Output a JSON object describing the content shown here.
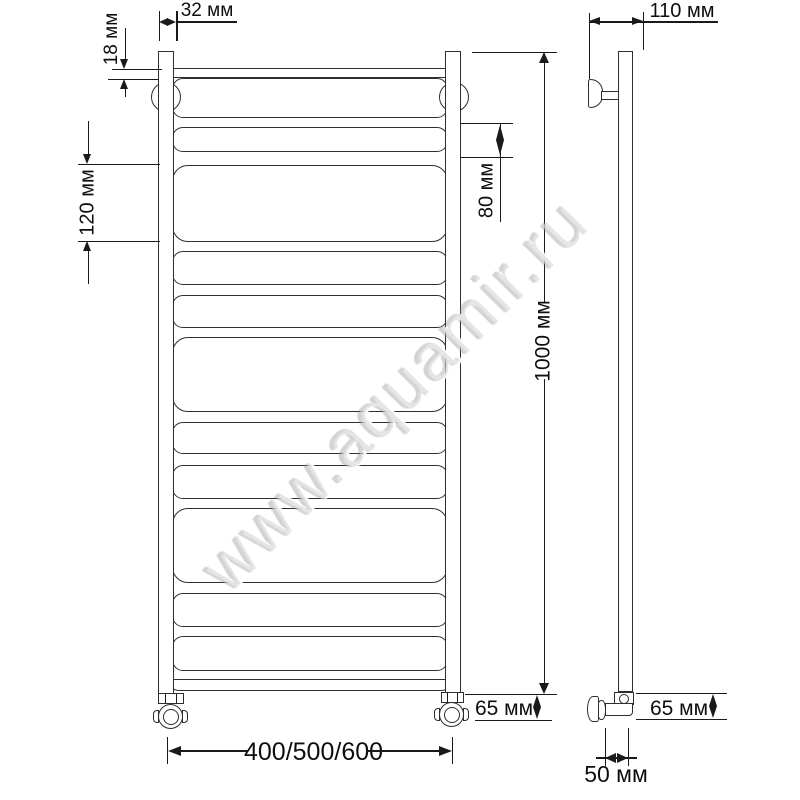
{
  "watermark": {
    "text": "www.aquamir.ru"
  },
  "front_view": {
    "labels": {
      "tube_width": "32 мм",
      "pipe_diameter": "18 мм",
      "section_height": "120 мм",
      "rung_spacing": "80 мм",
      "total_height": "1000 мм",
      "bottom_offset": "65 мм",
      "width_options": "400/500/600"
    }
  },
  "side_view": {
    "labels": {
      "wall_depth": "110 мм",
      "bottom_offset": "65 мм",
      "wall_clearance": "50 мм"
    }
  },
  "colors": {
    "line": "#2e2e2e",
    "dimension": "#1a1a1a",
    "watermark": "#d6d6d6"
  },
  "geometry": {
    "front_rungs": [
      {
        "y": 78,
        "h": 40
      },
      {
        "y": 127,
        "h": 25
      },
      {
        "y": 165,
        "h": 77
      },
      {
        "y": 251,
        "h": 34
      },
      {
        "y": 295,
        "h": 33
      },
      {
        "y": 337,
        "h": 75
      },
      {
        "y": 422,
        "h": 32
      },
      {
        "y": 465,
        "h": 34
      },
      {
        "y": 508,
        "h": 75
      },
      {
        "y": 593,
        "h": 34
      },
      {
        "y": 636,
        "h": 35
      }
    ],
    "side_holes": [
      77,
      111,
      147,
      243,
      278,
      314,
      415,
      450,
      486,
      587,
      621,
      655
    ]
  }
}
